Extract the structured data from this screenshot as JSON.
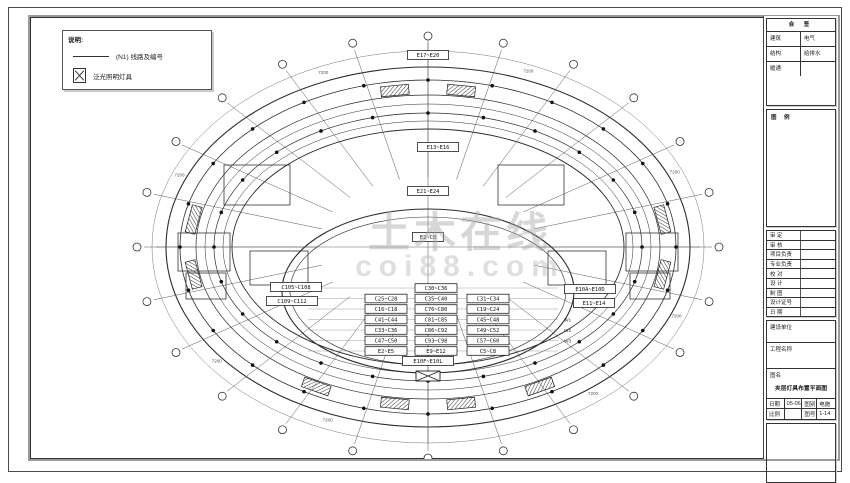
{
  "legend": {
    "title": "说明:",
    "items": [
      {
        "symbol": "polyline-symbol",
        "label": "(N1)  线路及编号"
      },
      {
        "symbol": "crossed-box-symbol",
        "label": "泛光照明灯具"
      }
    ]
  },
  "watermark": {
    "line1": "土木在线",
    "line2": "coi88.com"
  },
  "plan": {
    "boxed_labels": {
      "top": "E17~E20",
      "upper": "E13~E16",
      "mid": "E21~E24",
      "center": "E2~C8",
      "bottom": "E10F~E10L",
      "left1": "C105~C108",
      "left2": "C109~C112",
      "right1": "E10A~E10D",
      "right2": "E11~E14"
    },
    "circuit_grid": [
      [
        "",
        "C30~C36",
        ""
      ],
      [
        "C25~C28",
        "C35~C40",
        "C31~C34"
      ],
      [
        "C16~C18",
        "C76~C80",
        "C19~C24"
      ],
      [
        "C41~C44",
        "C81~C85",
        "C45~C48"
      ],
      [
        "C33~C36",
        "C86~C92",
        "C49~C52"
      ],
      [
        "C47~C50",
        "C93~C98",
        "C57~C60"
      ],
      [
        "E2~E5",
        "E9~E12",
        "C5~C8"
      ]
    ],
    "wire_labels": [
      "W1",
      "W2",
      "W3"
    ],
    "dim_label": "7200"
  },
  "title_block": {
    "sign_table": {
      "header": "会 签",
      "rows": [
        {
          "l": "建筑",
          "r": "电气"
        },
        {
          "l": "结构",
          "r": "给排水"
        },
        {
          "l": "暖通",
          "r": ""
        }
      ]
    },
    "legend_section_header": "图 例",
    "personnel_rows": [
      "审 定",
      "审 核",
      "项目负责",
      "专业负责",
      "校 对",
      "设 计",
      "制 图",
      "设计证号",
      "日 期"
    ],
    "bottom": {
      "owner_label": "建设单位",
      "project_label": "工程名称",
      "drawing_label": "图名",
      "drawing_name": "夹层灯具布置平面图",
      "meta": {
        "date_label": "日期",
        "date_value": "05-06",
        "type_label": "图别",
        "type_value": "电施",
        "scale_label": "比例",
        "scale_value": "",
        "no_label": "图号",
        "no_value": "1-14"
      }
    }
  }
}
